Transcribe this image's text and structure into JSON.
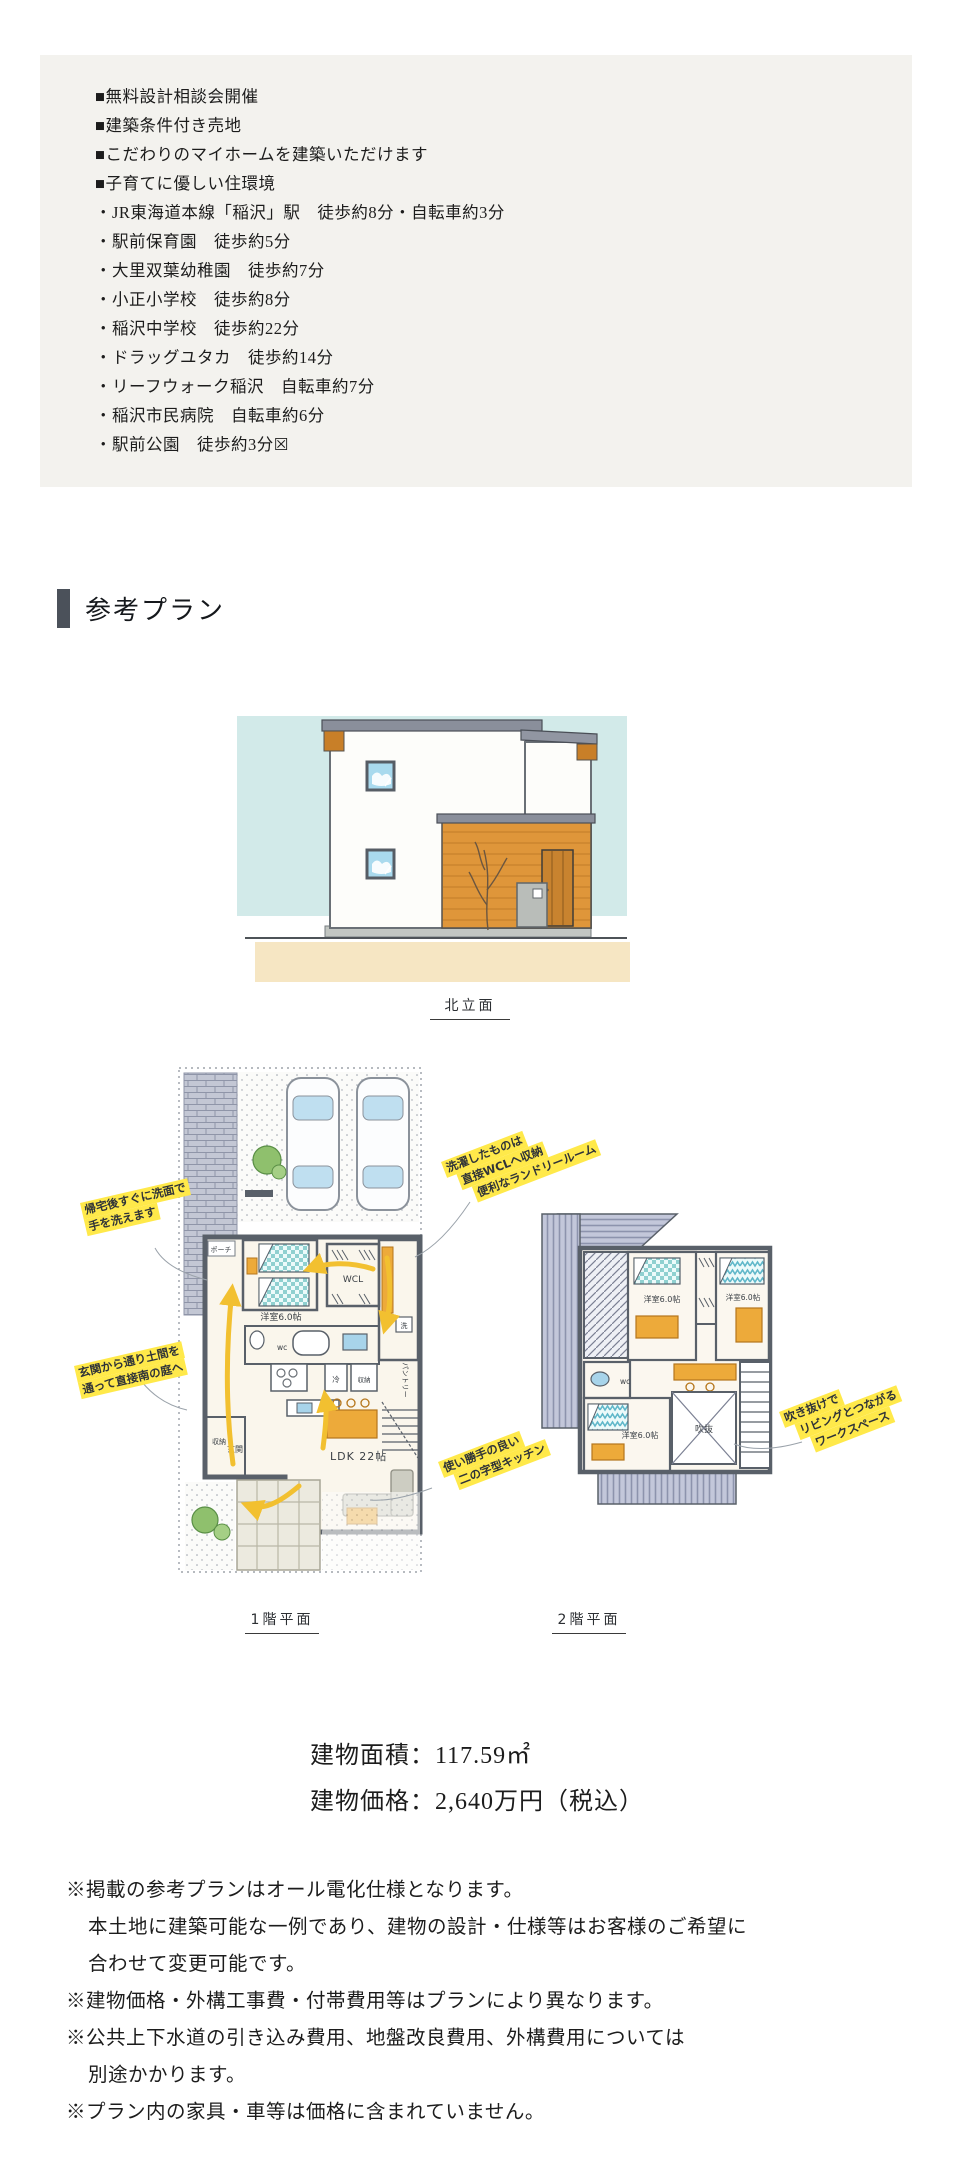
{
  "info_box": {
    "features": [
      "■無料設計相談会開催",
      "■建築条件付き売地",
      "■こだわりのマイホームを建築いただけます",
      "■子育てに優しい住環境"
    ],
    "access": [
      "・JR東海道本線「稲沢」駅　徒歩約8分・自転車約3分",
      "・駅前保育園　徒歩約5分",
      "・大里双葉幼稚園　徒歩約7分",
      "・小正小学校　徒歩約8分",
      "・稲沢中学校　徒歩約22分",
      "・ドラッグユタカ　徒歩約14分",
      "・リーフウォーク稲沢　自転車約7分",
      "・稲沢市民病院　自転車約6分",
      "・駅前公園　徒歩約3分☒"
    ]
  },
  "section": {
    "title": "参考プラン"
  },
  "drawings": {
    "elevation_caption": "北立面",
    "floor1_caption": "1階平面",
    "floor2_caption": "2階平面",
    "floor1_rooms": {
      "bedroom": "洋室6.0帖",
      "wcl": "WCL",
      "porch": "ポーチ",
      "wc": "wc",
      "fridge": "冷",
      "storage": "収納",
      "pantry": "パントリー",
      "washer": "洗",
      "entrance": "玄関",
      "entrance_storage": "収納",
      "ldk": "LDK 22帖"
    },
    "floor2_rooms": {
      "bedroom1": "洋室6.0帖",
      "bedroom2": "洋室6.0帖",
      "bedroom3": "洋室6.0帖",
      "wc": "wc",
      "void": "吹抜"
    },
    "annotations": {
      "wash": [
        "帰宅後すぐに洗面で",
        "手を洗えます"
      ],
      "doma": [
        "玄関から通り土間を",
        "通って直接南の庭へ"
      ],
      "laundry": [
        "洗濯したものは",
        "直接WCLへ収納",
        "便利なランドリールーム"
      ],
      "kitchen": [
        "使い勝手の良い",
        "二の字型キッチン"
      ],
      "workspace": [
        "吹き抜けで",
        "リビングとつながる",
        "ワークスペース"
      ]
    }
  },
  "building": {
    "area": "建物面積：117.59㎡",
    "price": "建物価格：2,640万円（税込）"
  },
  "notes": [
    "※掲載の参考プランはオール電化仕様となります。",
    "本土地に建築可能な一例であり、建物の設計・仕様等はお客様のご希望に",
    "合わせて変更可能です。",
    "※建物価格・外構工事費・付帯費用等はプランにより異なります。",
    "※公共上下水道の引き込み費用、地盤改良費用、外構費用については",
    "別途かかります。",
    "※プラン内の家具・車等は価格に含まれていません。"
  ],
  "colors": {
    "info_box_bg": "#f3f2ee",
    "accent_bar": "#4b515a",
    "highlight": "#ffe94a",
    "wood": "#e0973a",
    "teal": "#8fd0d0",
    "balcony": "#c3c7da",
    "arrow": "#f2c030"
  }
}
